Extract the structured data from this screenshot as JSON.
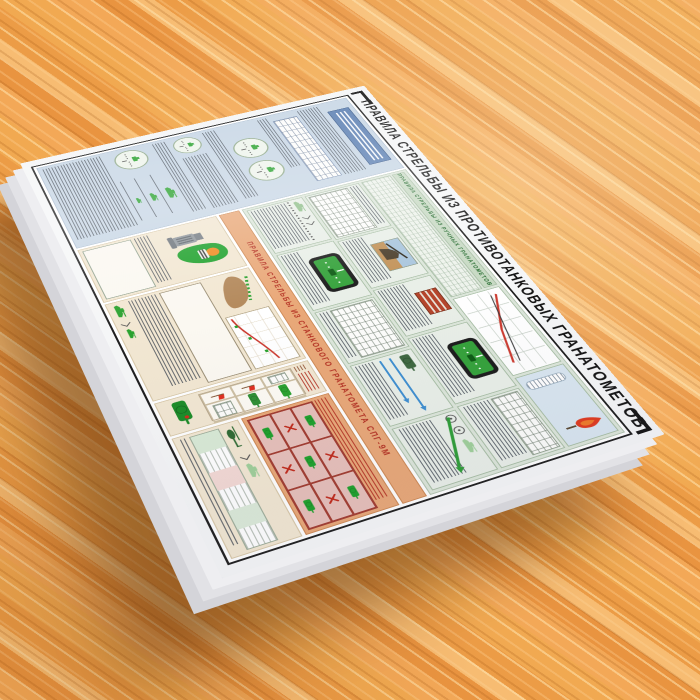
{
  "scene": {
    "description": "Photograph of a printed military wall chart lying at an angle on an orange wooden table",
    "surface": "wood"
  },
  "poster": {
    "title": "ПРАВИЛА СТРЕЛЬБЫ ИЗ ПРОТИВОТАНКОВЫХ ГРАНАТОМЕТОВ",
    "hand_section_title": "ПРАВИЛА СТРЕЛЬБЫ ИЗ РУЧНЫХ ГРАНАТОМЕТОВ",
    "mounted_section_title": "ПРАВИЛА СТРЕЛЬБЫ ИЗ СТАНКОВОГО ГРАНАТОМЕТА СПГ-9М",
    "colors": {
      "wood": "#ed9f4a",
      "poster_margin": "#f5f6f7",
      "blue_panel": "#c7d6e5",
      "blue_header": "#5b7fb2",
      "green_panel": "#dce6da",
      "green_band": "#c8dac4",
      "green_text": "#256b2f",
      "orange_band": "#e9a878",
      "orange_text": "#b43122",
      "beige_panel": "#f2e7d2",
      "pink_grid": "#e7c0ba",
      "tank_green": "#2aa22f",
      "graph_red": "#cc3b30",
      "arrow_blue": "#3f8fd0"
    }
  }
}
